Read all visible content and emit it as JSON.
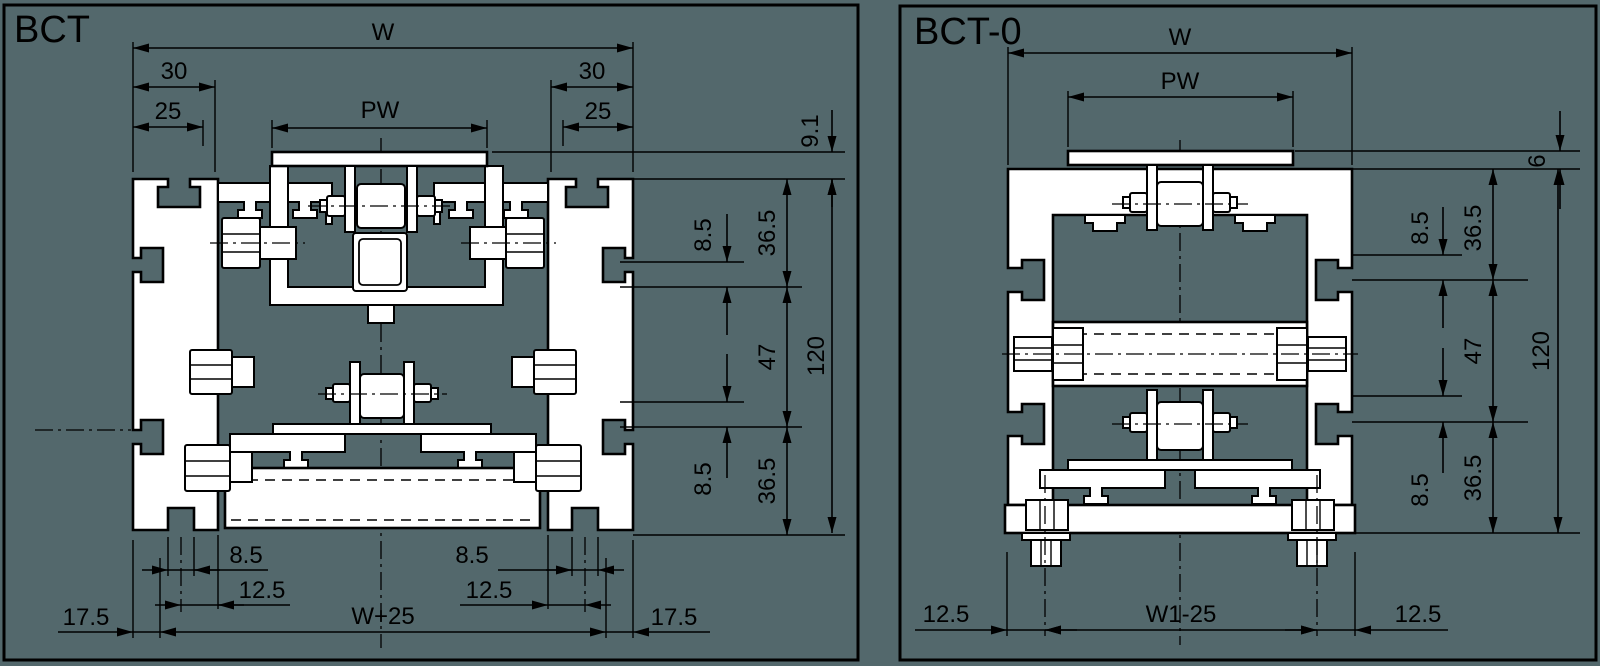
{
  "colors": {
    "background": "#53686C",
    "line": "#000000",
    "profile_fill": "#FFFFFF"
  },
  "bct": {
    "title": "BCT",
    "dims": {
      "w": "W",
      "left_30": "30",
      "left_25": "25",
      "pw": "PW",
      "right_30": "30",
      "right_25": "25",
      "offset_9_1": "9.1",
      "upper_8_5": "8.5",
      "upper_36_5": "36.5",
      "mid_47": "47",
      "overall_120": "120",
      "lower_8_5": "8.5",
      "lower_36_5": "36.5",
      "bottom_left_8_5": "8.5",
      "bottom_left_12_5": "12.5",
      "bottom_left_17_5": "17.5",
      "bottom_w_plus_25": "W+25",
      "bottom_right_8_5": "8.5",
      "bottom_right_12_5": "12.5",
      "bottom_right_17_5": "17.5"
    }
  },
  "bct0": {
    "title": "BCT-0",
    "dims": {
      "w": "W",
      "pw": "PW",
      "offset_6": "6",
      "upper_8_5": "8.5",
      "upper_36_5": "36.5",
      "mid_47": "47",
      "overall_120": "120",
      "lower_8_5": "8.5",
      "lower_36_5": "36.5",
      "bottom_left_12_5": "12.5",
      "bottom_w1_minus_25": "W1-25",
      "bottom_right_12_5": "12.5"
    }
  }
}
